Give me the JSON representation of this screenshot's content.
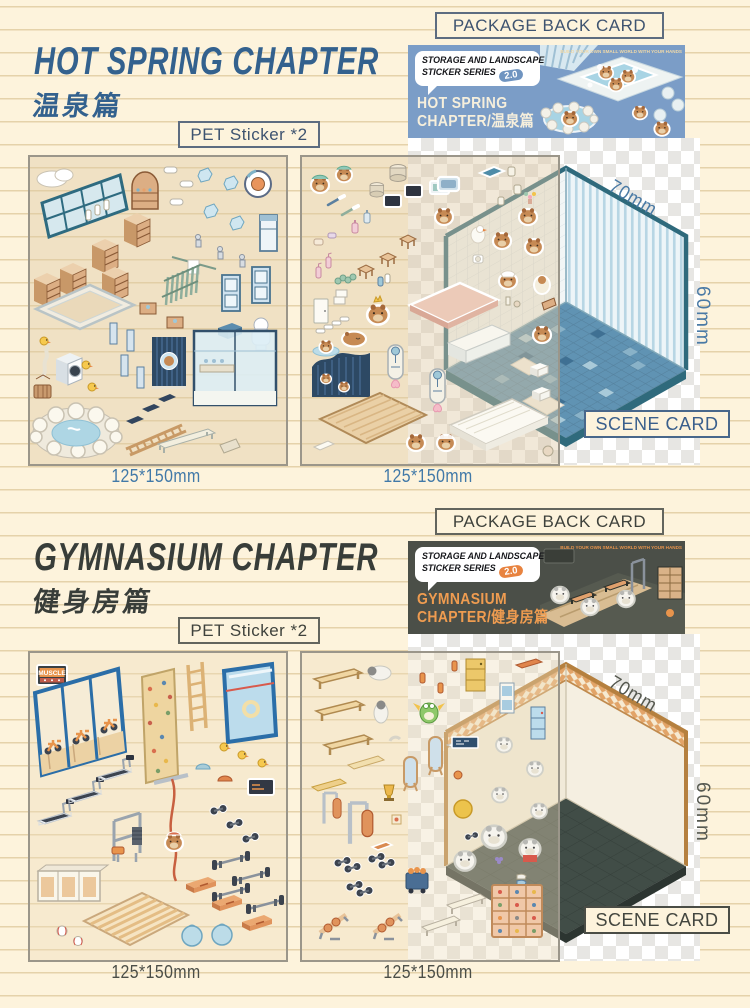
{
  "page": {
    "background_color": "#fdf3dc",
    "rule_line_color": "#e5d2aa",
    "checker_color": "#e7e6e3"
  },
  "sections": [
    {
      "id": "hot-spring",
      "accent_color": "#33618e",
      "package_back_card_label": "PACKAGE BACK CARD",
      "title": "HOT SPRING CHAPTER",
      "title_cn": "温泉篇",
      "pet_sticker_label": "PET Sticker *2",
      "package_card": {
        "bg_color": "#7b9dc7",
        "series_line1": "STORAGE AND LANDSCAPE",
        "series_line2": "STICKER SERIES",
        "version_badge": "2.0",
        "chapter_line1": "HOT SPRING",
        "chapter_line2": "CHAPTER/温泉篇",
        "tagline": "BUILD YOUR OWN SMALL WORLD WITH YOUR HANDS"
      },
      "sticker_sheets": [
        {
          "size_label": "125*150mm"
        },
        {
          "size_label": "125*150mm"
        }
      ],
      "scene_card": {
        "label": "SCENE CARD",
        "width_label": "70mm",
        "height_label": "60mm",
        "floor_color": "#6093b3",
        "wall_stripe_color": "#b7d6e4",
        "trim_color": "#2f6a7c"
      }
    },
    {
      "id": "gymnasium",
      "accent_color": "#383d39",
      "package_back_card_label": "PACKAGE BACK CARD",
      "title": "GYMNASIUM CHAPTER",
      "title_cn": "健身房篇",
      "pet_sticker_label": "PET Sticker *2",
      "sheet_sign_text": "MUSCLE",
      "package_card": {
        "bg_color": "#4b4f48",
        "series_line1": "STORAGE AND LANDSCAPE",
        "series_line2": "STICKER SERIES",
        "version_badge": "2.0",
        "chapter_line1": "GYMNASIUM",
        "chapter_line2": "CHAPTER/健身房篇",
        "tagline": "BUILD YOUR OWN SMALL WORLD WITH YOUR HANDS"
      },
      "sticker_sheets": [
        {
          "size_label": "125*150mm"
        },
        {
          "size_label": "125*150mm"
        }
      ],
      "scene_card": {
        "label": "SCENE CARD",
        "width_label": "70mm",
        "height_label": "60mm",
        "floor_color": "#414d47",
        "wall_color": "#f5efe1",
        "band_color": "#e2a468"
      }
    }
  ]
}
